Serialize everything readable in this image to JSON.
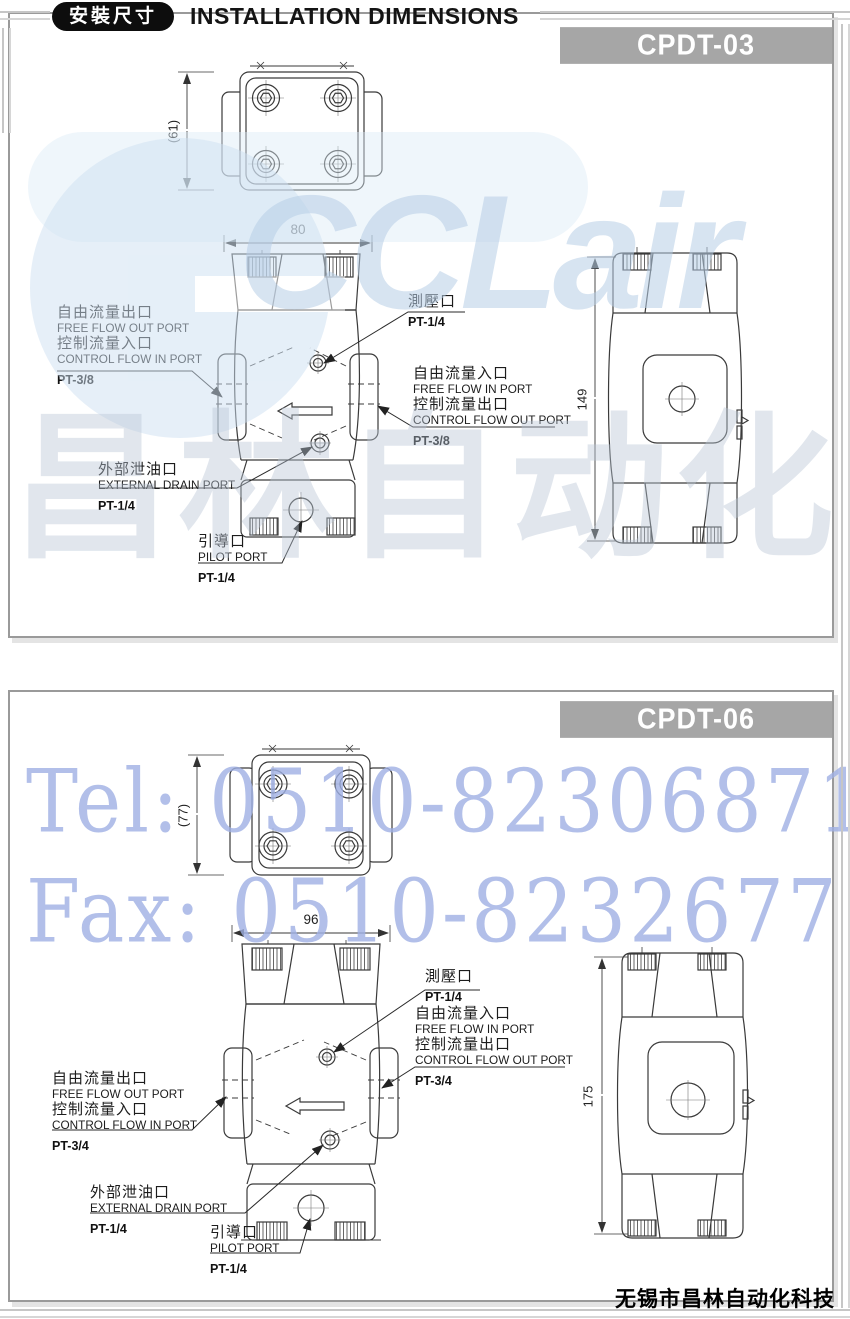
{
  "header": {
    "badge_zh": "安裝尺寸",
    "title_en": "INSTALLATION DIMENSIONS"
  },
  "watermarks": {
    "brand_latin": "CCLair",
    "brand_cn": "昌林自动化",
    "tel": "Tel: 0510-82306871",
    "fax": "Fax: 0510-82326771"
  },
  "footer": {
    "company": "无锡市昌林自动化科技"
  },
  "colors": {
    "model_bar_bg": "#a6a6a6",
    "drawing_line": "#3a3a3a",
    "watermark_blue": "#b7cee6",
    "watermark_phone_blue": "#9fb0e4"
  },
  "sections": [
    {
      "model": "CPDT-03",
      "dims": {
        "top_view_height": "(61)",
        "body_width": "80",
        "side_view_height": "149"
      },
      "labels": {
        "free_out": {
          "zh1": "自由流量出口",
          "en1": "FREE FLOW OUT PORT",
          "zh2": "控制流量入口",
          "en2": "CONTROL FLOW IN PORT",
          "size": "PT-3/8"
        },
        "gauge": {
          "zh": "測壓口",
          "size": "PT-1/4"
        },
        "free_in": {
          "zh1": "自由流量入口",
          "en1": "FREE FLOW IN PORT",
          "zh2": "控制流量出口",
          "en2": "CONTROL FLOW OUT PORT",
          "size": "PT-3/8"
        },
        "drain": {
          "zh": "外部泄油口",
          "en": "EXTERNAL DRAIN PORT",
          "size": "PT-1/4"
        },
        "pilot": {
          "zh": "引導口",
          "en": "PILOT PORT",
          "size": "PT-1/4"
        }
      }
    },
    {
      "model": "CPDT-06",
      "dims": {
        "top_view_height": "(77)",
        "body_width": "96",
        "side_view_height": "175"
      },
      "labels": {
        "free_out": {
          "zh1": "自由流量出口",
          "en1": "FREE FLOW OUT PORT",
          "zh2": "控制流量入口",
          "en2": "CONTROL FLOW IN PORT",
          "size": "PT-3/4"
        },
        "gauge": {
          "zh": "測壓口",
          "size": "PT-1/4"
        },
        "free_in": {
          "zh1": "自由流量入口",
          "en1": "FREE FLOW IN PORT",
          "zh2": "控制流量出口",
          "en2": "CONTROL FLOW OUT PORT",
          "size": "PT-3/4"
        },
        "drain": {
          "zh": "外部泄油口",
          "en": "EXTERNAL DRAIN PORT",
          "size": "PT-1/4"
        },
        "pilot": {
          "zh": "引導口",
          "en": "PILOT PORT",
          "size": "PT-1/4"
        }
      }
    }
  ]
}
